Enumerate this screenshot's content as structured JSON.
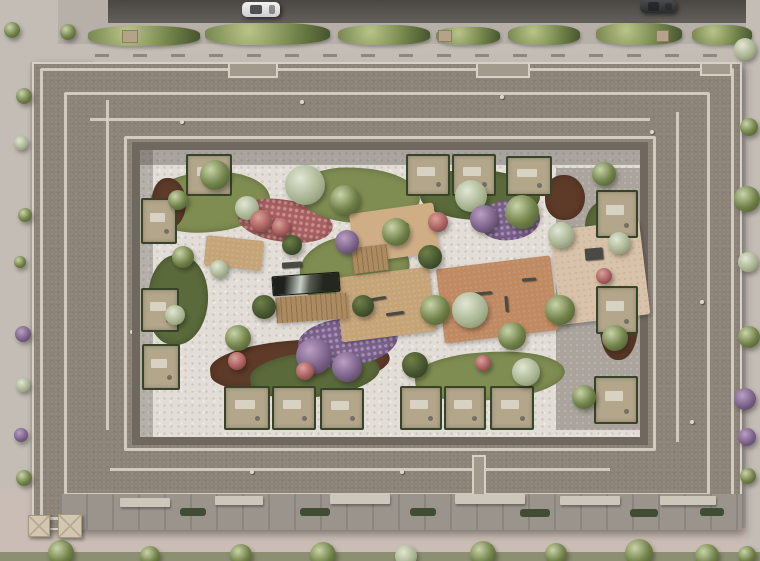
{
  "meta": {
    "title": "Aerial top-down render of a perimeter-block residential building with landscaped inner courtyard",
    "description": "Bird's-eye architectural visualization: grey stepped roof ring around a courtyard with white pebble paths, lawns, flower beds, playgrounds, a reflecting pool and private hedge-lined terraces; streets with cars above and sidewalks with trees around."
  },
  "scene": {
    "colors": {
      "pavement": "#b6b0a9",
      "pavementLight": "#c3bdb5",
      "roadDark": "#55514b",
      "roofMain": "#8c8478",
      "roofLight": "#a29a8d",
      "parapet": "#d7d1c5",
      "facadeShadow": "#6f685e",
      "courtyardPath": "#e2ddd6",
      "stonePath": "#aaa49c",
      "lawn": "#7f8d52",
      "lawnDark": "#5a6a3a",
      "mulch": "#5e3a28",
      "flowersRed": "#a85f5f",
      "flowersPink": "#c98f8f",
      "bushPurple": "#7b6288",
      "treeGreen": "#6f8047",
      "treeDark": "#46552f",
      "treeSilver": "#aab694",
      "hedge": "#36452a",
      "terrace": "#b3a68a",
      "deck": "#ad8b60",
      "pool": "#24271f",
      "playTan": "#c5a478",
      "fitnessClay": "#c08a62",
      "plazaPale": "#d8c2a9",
      "sidewalkPink": "#c9bdb5",
      "umbrella": "#d2c7b1"
    }
  },
  "street": {
    "cars": [
      {
        "name": "white-car",
        "x": 242,
        "y": 2,
        "w": 38,
        "h": 15,
        "kind": "white"
      },
      {
        "name": "dark-car",
        "x": 640,
        "y": 0,
        "w": 36,
        "h": 13,
        "kind": "dark"
      }
    ],
    "top_bushes": [
      {
        "x": 88,
        "y": 26,
        "w": 112,
        "h": 20
      },
      {
        "x": 205,
        "y": 23,
        "w": 125,
        "h": 22
      },
      {
        "x": 338,
        "y": 25,
        "w": 92,
        "h": 20,
        "tone": "silver"
      },
      {
        "x": 436,
        "y": 27,
        "w": 64,
        "h": 18
      },
      {
        "x": 508,
        "y": 25,
        "w": 72,
        "h": 20
      },
      {
        "x": 596,
        "y": 23,
        "w": 86,
        "h": 22
      },
      {
        "x": 692,
        "y": 25,
        "w": 60,
        "h": 20,
        "tone": "silver"
      }
    ],
    "top_planters": [
      {
        "x": 122,
        "y": 30,
        "w": 16,
        "h": 13
      },
      {
        "x": 438,
        "y": 30,
        "w": 14,
        "h": 12
      },
      {
        "x": 656,
        "y": 30,
        "w": 13,
        "h": 12
      }
    ],
    "plaza_trees": [
      {
        "x": 4,
        "y": 22,
        "d": 16
      },
      {
        "x": 60,
        "y": 24,
        "d": 16
      }
    ],
    "left_bushes": [
      {
        "x": 16,
        "y": 88,
        "d": 16
      },
      {
        "x": 14,
        "y": 136,
        "d": 14,
        "tone": "silver"
      },
      {
        "x": 18,
        "y": 208,
        "d": 14
      },
      {
        "x": 14,
        "y": 256,
        "d": 12
      },
      {
        "x": 15,
        "y": 326,
        "d": 16,
        "tone": "purple"
      },
      {
        "x": 16,
        "y": 378,
        "d": 14,
        "tone": "silver"
      },
      {
        "x": 14,
        "y": 428,
        "d": 14,
        "tone": "purple"
      },
      {
        "x": 16,
        "y": 470,
        "d": 16
      }
    ],
    "right_bushes": [
      {
        "x": 734,
        "y": 38,
        "d": 22,
        "tone": "silver"
      },
      {
        "x": 740,
        "y": 118,
        "d": 18
      },
      {
        "x": 734,
        "y": 186,
        "d": 26
      },
      {
        "x": 738,
        "y": 252,
        "d": 20,
        "tone": "silver"
      },
      {
        "x": 738,
        "y": 326,
        "d": 22
      },
      {
        "x": 734,
        "y": 388,
        "d": 22,
        "tone": "purple"
      },
      {
        "x": 738,
        "y": 428,
        "d": 18,
        "tone": "purple"
      },
      {
        "x": 740,
        "y": 468,
        "d": 16
      }
    ],
    "bottom_trees": [
      {
        "x": 48,
        "y": 540,
        "d": 26
      },
      {
        "x": 140,
        "y": 546,
        "d": 20
      },
      {
        "x": 230,
        "y": 544,
        "d": 22
      },
      {
        "x": 310,
        "y": 542,
        "d": 26
      },
      {
        "x": 395,
        "y": 545,
        "d": 22,
        "tone": "silver"
      },
      {
        "x": 470,
        "y": 541,
        "d": 26
      },
      {
        "x": 545,
        "y": 543,
        "d": 22
      },
      {
        "x": 625,
        "y": 539,
        "d": 28
      },
      {
        "x": 695,
        "y": 544,
        "d": 24
      },
      {
        "x": 738,
        "y": 546,
        "d": 18
      }
    ],
    "umbrellas": [
      {
        "x": 28,
        "y": 515,
        "w": 22,
        "h": 22
      },
      {
        "x": 58,
        "y": 514,
        "w": 24,
        "h": 24
      }
    ]
  },
  "roof": {
    "notches": [
      {
        "x": 228,
        "y": 62,
        "w": 50,
        "h": 16
      },
      {
        "x": 476,
        "y": 62,
        "w": 54,
        "h": 16
      },
      {
        "x": 700,
        "y": 62,
        "w": 32,
        "h": 14
      },
      {
        "x": 472,
        "y": 455,
        "w": 14,
        "h": 75
      }
    ],
    "vents": [
      {
        "x": 130,
        "y": 330,
        "d": 4
      },
      {
        "x": 180,
        "y": 120,
        "d": 4
      },
      {
        "x": 300,
        "y": 100,
        "d": 4
      },
      {
        "x": 500,
        "y": 95,
        "d": 4
      },
      {
        "x": 650,
        "y": 130,
        "d": 4
      },
      {
        "x": 700,
        "y": 300,
        "d": 4
      },
      {
        "x": 690,
        "y": 420,
        "d": 4
      },
      {
        "x": 400,
        "y": 470,
        "d": 4
      },
      {
        "x": 250,
        "y": 470,
        "d": 4
      },
      {
        "x": 150,
        "y": 430,
        "d": 4
      }
    ],
    "canopies": [
      {
        "x": 120,
        "y": 498,
        "w": 50,
        "h": 9
      },
      {
        "x": 215,
        "y": 496,
        "w": 48,
        "h": 9
      },
      {
        "x": 330,
        "y": 494,
        "w": 60,
        "h": 10
      },
      {
        "x": 455,
        "y": 494,
        "w": 70,
        "h": 10
      },
      {
        "x": 560,
        "y": 496,
        "w": 60,
        "h": 9
      },
      {
        "x": 660,
        "y": 496,
        "w": 56,
        "h": 9
      }
    ],
    "hedge_bits": [
      {
        "x": 300,
        "y": 508,
        "w": 30,
        "h": 8
      },
      {
        "x": 410,
        "y": 508,
        "w": 26,
        "h": 8
      },
      {
        "x": 520,
        "y": 509,
        "w": 30,
        "h": 8
      },
      {
        "x": 630,
        "y": 509,
        "w": 28,
        "h": 8
      },
      {
        "x": 700,
        "y": 508,
        "w": 24,
        "h": 8
      },
      {
        "x": 180,
        "y": 508,
        "w": 26,
        "h": 8
      }
    ]
  },
  "courtyard": {
    "patches": [
      {
        "x": 150,
        "y": 172,
        "w": 120,
        "h": 60,
        "kind": "lawn",
        "rot": -5
      },
      {
        "x": 152,
        "y": 178,
        "w": 34,
        "h": 50,
        "kind": "mulch"
      },
      {
        "x": 238,
        "y": 200,
        "w": 95,
        "h": 42,
        "kind": "red",
        "rot": 8
      },
      {
        "x": 300,
        "y": 168,
        "w": 120,
        "h": 55,
        "kind": "lawn",
        "rot": 3
      },
      {
        "x": 420,
        "y": 170,
        "w": 120,
        "h": 50,
        "kind": "lawndark",
        "rot": 2
      },
      {
        "x": 545,
        "y": 175,
        "w": 40,
        "h": 45,
        "kind": "mulch"
      },
      {
        "x": 300,
        "y": 235,
        "w": 110,
        "h": 70,
        "kind": "lawn",
        "rot": -10
      },
      {
        "x": 148,
        "y": 255,
        "w": 60,
        "h": 90,
        "kind": "lawndark",
        "rot": 5
      },
      {
        "x": 210,
        "y": 340,
        "w": 180,
        "h": 50,
        "kind": "mulch",
        "rot": -5
      },
      {
        "x": 250,
        "y": 352,
        "w": 130,
        "h": 45,
        "kind": "lawndark",
        "rot": -6
      },
      {
        "x": 415,
        "y": 352,
        "w": 150,
        "h": 48,
        "kind": "lawn",
        "rot": -4
      },
      {
        "x": 585,
        "y": 200,
        "w": 50,
        "h": 60,
        "kind": "lawndark"
      },
      {
        "x": 600,
        "y": 290,
        "w": 38,
        "h": 70,
        "kind": "mulch"
      },
      {
        "x": 480,
        "y": 200,
        "w": 60,
        "h": 40,
        "kind": "purplebed",
        "rot": -6
      },
      {
        "x": 298,
        "y": 318,
        "w": 100,
        "h": 48,
        "kind": "purplebed",
        "rot": -8
      },
      {
        "x": 360,
        "y": 210,
        "w": 60,
        "h": 40,
        "kind": "lawndark",
        "rot": -8
      }
    ],
    "areas": [
      {
        "name": "toddler-sand-area",
        "x": 352,
        "y": 208,
        "w": 85,
        "h": 50,
        "rot": -8,
        "kind": "sand"
      },
      {
        "name": "playground-area",
        "x": 338,
        "y": 272,
        "w": 95,
        "h": 65,
        "rot": -7,
        "kind": "tan"
      },
      {
        "name": "fitness-area",
        "x": 440,
        "y": 262,
        "w": 115,
        "h": 75,
        "rot": -7,
        "kind": "clay"
      },
      {
        "name": "plaza-area",
        "x": 555,
        "y": 225,
        "w": 90,
        "h": 95,
        "rot": -7,
        "kind": "pale"
      },
      {
        "name": "left-patio",
        "x": 205,
        "y": 238,
        "w": 58,
        "h": 30,
        "rot": 6,
        "kind": "tan"
      },
      {
        "name": "reflecting-pool",
        "x": 272,
        "y": 274,
        "w": 66,
        "h": 18,
        "rot": -4,
        "kind": "pool"
      },
      {
        "name": "wood-deck",
        "x": 276,
        "y": 295,
        "w": 72,
        "h": 26,
        "rot": -4,
        "kind": "deck"
      },
      {
        "name": "wood-platform",
        "x": 352,
        "y": 246,
        "w": 36,
        "h": 26,
        "rot": -7,
        "kind": "deck"
      }
    ],
    "terraces": [
      {
        "x": 141,
        "y": 198,
        "w": 36,
        "h": 46
      },
      {
        "x": 141,
        "y": 288,
        "w": 38,
        "h": 44
      },
      {
        "x": 142,
        "y": 344,
        "w": 38,
        "h": 46
      },
      {
        "x": 186,
        "y": 154,
        "w": 46,
        "h": 42
      },
      {
        "x": 406,
        "y": 154,
        "w": 44,
        "h": 42
      },
      {
        "x": 452,
        "y": 154,
        "w": 44,
        "h": 42
      },
      {
        "x": 506,
        "y": 156,
        "w": 46,
        "h": 40
      },
      {
        "x": 596,
        "y": 190,
        "w": 42,
        "h": 48
      },
      {
        "x": 596,
        "y": 286,
        "w": 42,
        "h": 48
      },
      {
        "x": 594,
        "y": 376,
        "w": 44,
        "h": 48
      },
      {
        "x": 224,
        "y": 386,
        "w": 46,
        "h": 44
      },
      {
        "x": 272,
        "y": 386,
        "w": 44,
        "h": 44
      },
      {
        "x": 320,
        "y": 388,
        "w": 44,
        "h": 42
      },
      {
        "x": 400,
        "y": 386,
        "w": 42,
        "h": 44
      },
      {
        "x": 444,
        "y": 386,
        "w": 42,
        "h": 44
      },
      {
        "x": 490,
        "y": 386,
        "w": 44,
        "h": 44
      }
    ],
    "trees": [
      {
        "x": 200,
        "y": 160,
        "d": 30
      },
      {
        "x": 235,
        "y": 196,
        "d": 24,
        "tone": "silver"
      },
      {
        "x": 285,
        "y": 165,
        "d": 40,
        "tone": "silver"
      },
      {
        "x": 330,
        "y": 185,
        "d": 30
      },
      {
        "x": 382,
        "y": 218,
        "d": 28
      },
      {
        "x": 418,
        "y": 245,
        "d": 24,
        "tone": "dark"
      },
      {
        "x": 455,
        "y": 180,
        "d": 32,
        "tone": "silver"
      },
      {
        "x": 505,
        "y": 195,
        "d": 34
      },
      {
        "x": 548,
        "y": 222,
        "d": 26,
        "tone": "silver"
      },
      {
        "x": 592,
        "y": 162,
        "d": 24
      },
      {
        "x": 420,
        "y": 295,
        "d": 30
      },
      {
        "x": 452,
        "y": 292,
        "d": 36,
        "tone": "silver"
      },
      {
        "x": 498,
        "y": 322,
        "d": 28
      },
      {
        "x": 545,
        "y": 295,
        "d": 30
      },
      {
        "x": 602,
        "y": 325,
        "d": 26
      },
      {
        "x": 296,
        "y": 338,
        "d": 36,
        "tone": "purple"
      },
      {
        "x": 332,
        "y": 352,
        "d": 30,
        "tone": "purple"
      },
      {
        "x": 225,
        "y": 325,
        "d": 26
      },
      {
        "x": 172,
        "y": 246,
        "d": 22
      },
      {
        "x": 165,
        "y": 305,
        "d": 20,
        "tone": "silver"
      },
      {
        "x": 252,
        "y": 295,
        "d": 24,
        "tone": "dark"
      },
      {
        "x": 512,
        "y": 358,
        "d": 28,
        "tone": "silver"
      },
      {
        "x": 572,
        "y": 385,
        "d": 24
      },
      {
        "x": 402,
        "y": 352,
        "d": 26,
        "tone": "dark"
      },
      {
        "x": 352,
        "y": 295,
        "d": 22,
        "tone": "dark"
      },
      {
        "x": 282,
        "y": 235,
        "d": 20,
        "tone": "dark"
      },
      {
        "x": 470,
        "y": 205,
        "d": 28,
        "tone": "purple"
      },
      {
        "x": 335,
        "y": 230,
        "d": 24,
        "tone": "purple"
      },
      {
        "x": 608,
        "y": 232,
        "d": 22,
        "tone": "silver"
      },
      {
        "x": 250,
        "y": 210,
        "d": 22,
        "tone": "red"
      },
      {
        "x": 272,
        "y": 218,
        "d": 18,
        "tone": "red"
      },
      {
        "x": 428,
        "y": 212,
        "d": 20,
        "tone": "red"
      },
      {
        "x": 296,
        "y": 362,
        "d": 18,
        "tone": "red"
      },
      {
        "x": 475,
        "y": 355,
        "d": 16,
        "tone": "red"
      },
      {
        "x": 228,
        "y": 352,
        "d": 18,
        "tone": "red"
      },
      {
        "x": 596,
        "y": 268,
        "d": 16,
        "tone": "red"
      },
      {
        "x": 168,
        "y": 190,
        "d": 20
      },
      {
        "x": 210,
        "y": 260,
        "d": 18,
        "tone": "silver"
      }
    ],
    "equipment": [
      {
        "x": 360,
        "y": 298,
        "w": 26,
        "h": 3,
        "rot": -10
      },
      {
        "x": 386,
        "y": 312,
        "w": 18,
        "h": 3,
        "rot": -8
      },
      {
        "x": 470,
        "y": 292,
        "w": 22,
        "h": 3,
        "rot": -5
      },
      {
        "x": 505,
        "y": 296,
        "w": 3,
        "h": 16,
        "rot": -5
      },
      {
        "x": 522,
        "y": 278,
        "w": 14,
        "h": 3,
        "rot": -5
      },
      {
        "x": 392,
        "y": 224,
        "w": 16,
        "h": 3,
        "rot": -8
      },
      {
        "x": 585,
        "y": 248,
        "w": 18,
        "h": 12,
        "rot": -5
      },
      {
        "x": 282,
        "y": 262,
        "w": 20,
        "h": 6,
        "rot": -4
      }
    ]
  }
}
